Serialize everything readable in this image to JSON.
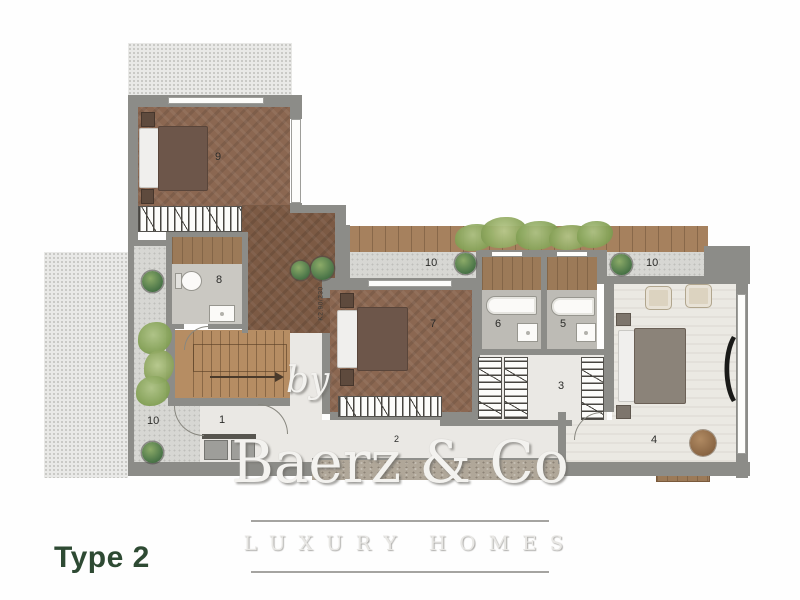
{
  "plan": {
    "title": "Type 2",
    "door_tag": "K2.90/230",
    "room_labels": {
      "bedroom_9": "9",
      "bathroom_8": "8",
      "bedroom_7": "7",
      "bathroom_6": "6",
      "bathroom_5": "5",
      "dressing_3": "3",
      "master_bedroom_4": "4",
      "entry_1": "1",
      "hallway_2": "2",
      "terrace_left_10": "10",
      "balcony_middle_10": "10",
      "balcony_right_10": "10"
    },
    "colors": {
      "title_green": "#2e4a33",
      "wall_gray": "#8c8c88",
      "wood_floor": "#8b6751",
      "deck_wood": "#a6815e",
      "light_floor": "#ebe9e3",
      "terrace_gray": "#d7d7d3",
      "plant_green": "#527b4c",
      "watermark_gray": "#f3f2ef"
    }
  },
  "watermark": {
    "by": "by",
    "brand": "Baerz & Co",
    "tagline": "LUXURY HOMES"
  }
}
